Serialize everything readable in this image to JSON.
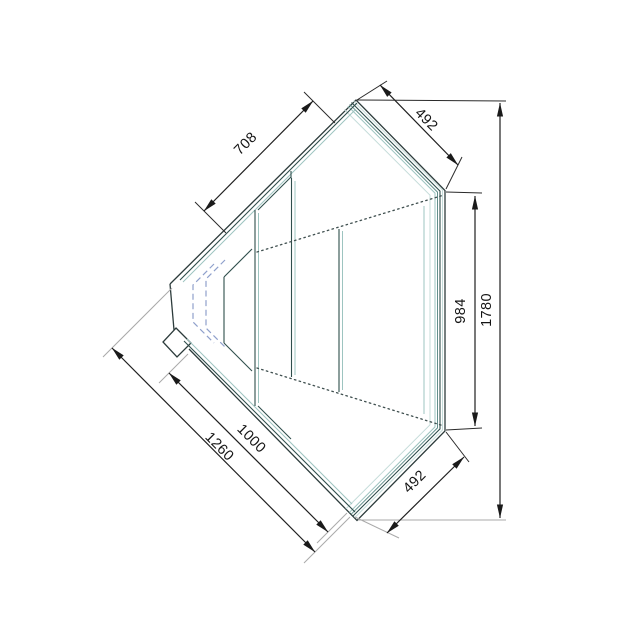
{
  "drawing": {
    "kind": "corner-display-counter-plan-view",
    "dimensions_mm": {
      "back_top_edge": "708",
      "front_glass_top": "492",
      "right_inner": "984",
      "right_overall": "1780",
      "front_glass_bottom": "492",
      "depth_inner": "1000",
      "depth_overall": "1260"
    },
    "colors": {
      "background": "#ffffff",
      "dimension_lines": "#1f1f1f",
      "body_outline": "#2c3b3b",
      "glass_teal_dark": "#2f4e4c",
      "glass_teal_light": "#9dc4c0",
      "hidden_edge_dots": "#3f4f4f",
      "hidden_corner_dash": "#8fa0cc",
      "extension_gray": "#a9a9a9"
    }
  }
}
